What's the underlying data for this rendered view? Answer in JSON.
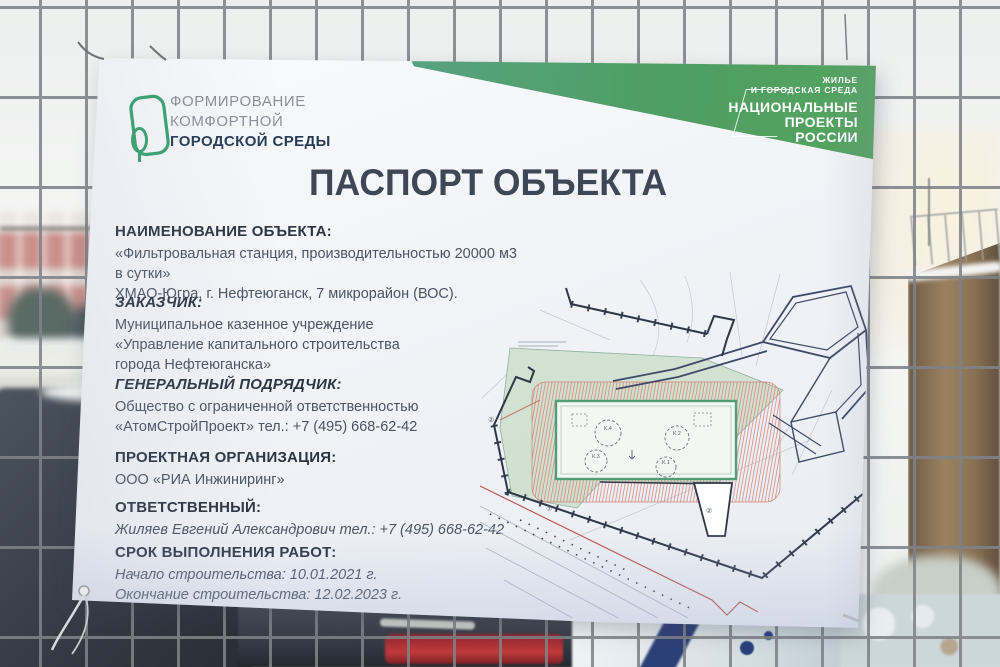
{
  "banner": {
    "program_logo": {
      "line1": "ФОРМИРОВАНИЕ",
      "line2": "КОМФОРТНОЙ",
      "line3": "ГОРОДСКОЙ СРЕДЫ"
    },
    "national_projects_badge": {
      "top_line1": "ЖИЛЬЕ",
      "top_line2": "И ГОРОДСКАЯ СРЕДА",
      "line1": "НАЦИОНАЛЬНЫЕ",
      "line2": "ПРОЕКТЫ",
      "line3": "РОССИИ"
    },
    "title": "ПАСПОРТ ОБЪЕКТА",
    "sections": [
      {
        "label": "НАИМЕНОВАНИЕ ОБЪЕКТА:",
        "lines": [
          "«Фильтровальная станция, производительностью 20000 м3 в сутки»",
          "ХМАО-Югра, г. Нефтеюганск, 7 микрорайон (ВОС)."
        ]
      },
      {
        "label": "ЗАКАЗЧИК:",
        "lines": [
          "Муниципальное казенное учреждение",
          "«Управление капитального строительства",
          "города Нефтеюганска»"
        ]
      },
      {
        "label": "ГЕНЕРАЛЬНЫЙ ПОДРЯДЧИК:",
        "lines": [
          "Общество с ограниченной ответственностью",
          "«АтомСтройПроект» тел.: +7 (495) 668-62-42"
        ]
      },
      {
        "label": "ПРОЕКТНАЯ ОРГАНИЗАЦИЯ:",
        "lines": [
          "ООО «РИА Инжиниринг»"
        ]
      },
      {
        "label": "ОТВЕТСТВЕННЫЙ:",
        "lines": [
          "Жиляев Евгений Александрович тел.: +7 (495) 668-62-42"
        ]
      },
      {
        "label": "СРОК ВЫПОЛНЕНИЯ РАБОТ:",
        "lines": [
          "Начало строительства: 10.01.2021 г.",
          "Окончание строительства: 12.02.2023 г."
        ]
      }
    ],
    "site_plan": {
      "tank_labels": [
        "К.1",
        "К.2",
        "К.3",
        "К.4"
      ],
      "circled_marks": [
        "②",
        "⑦",
        "②"
      ]
    },
    "colors": {
      "accent_teal": "#5aa38b",
      "accent_green": "#4f9e62",
      "logo_green": "#35a06c",
      "heading_navy": "#273b55",
      "title_gray": "#3e4755",
      "body_gray": "#4b5463",
      "plan_red": "#c0564c",
      "plan_site_green": "#cfe0cf"
    }
  }
}
